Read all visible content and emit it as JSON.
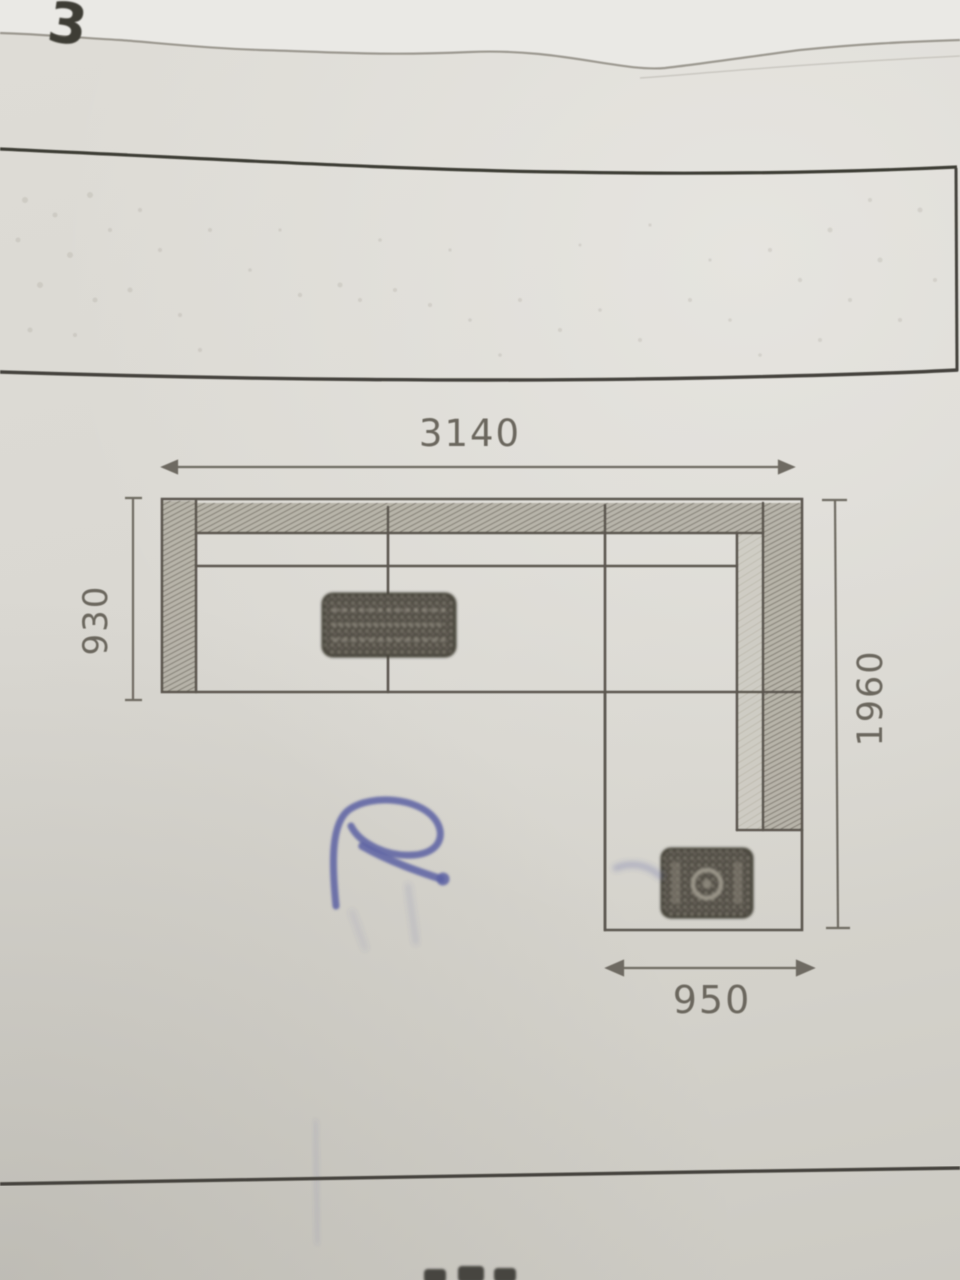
{
  "photo": {
    "description": "pencil technical drawing of an L-shaped sectional sofa, top view, on photographed paper form",
    "corner_mark": "3"
  },
  "drawing": {
    "dimensions": {
      "top_width": "3140",
      "left_depth": "930",
      "right_length": "1960",
      "chaise_width": "950"
    },
    "artifacts": {
      "center_stamp": "illegible-hatched-stamp",
      "chaise_stamp": "illegible-hatched-stamp",
      "pen_mark": "blue-ballpoint-scribble"
    },
    "colors": {
      "paper": "#d9d7d0",
      "pencil": "#5f5b53",
      "pen_blue": "#5c62a2"
    }
  }
}
